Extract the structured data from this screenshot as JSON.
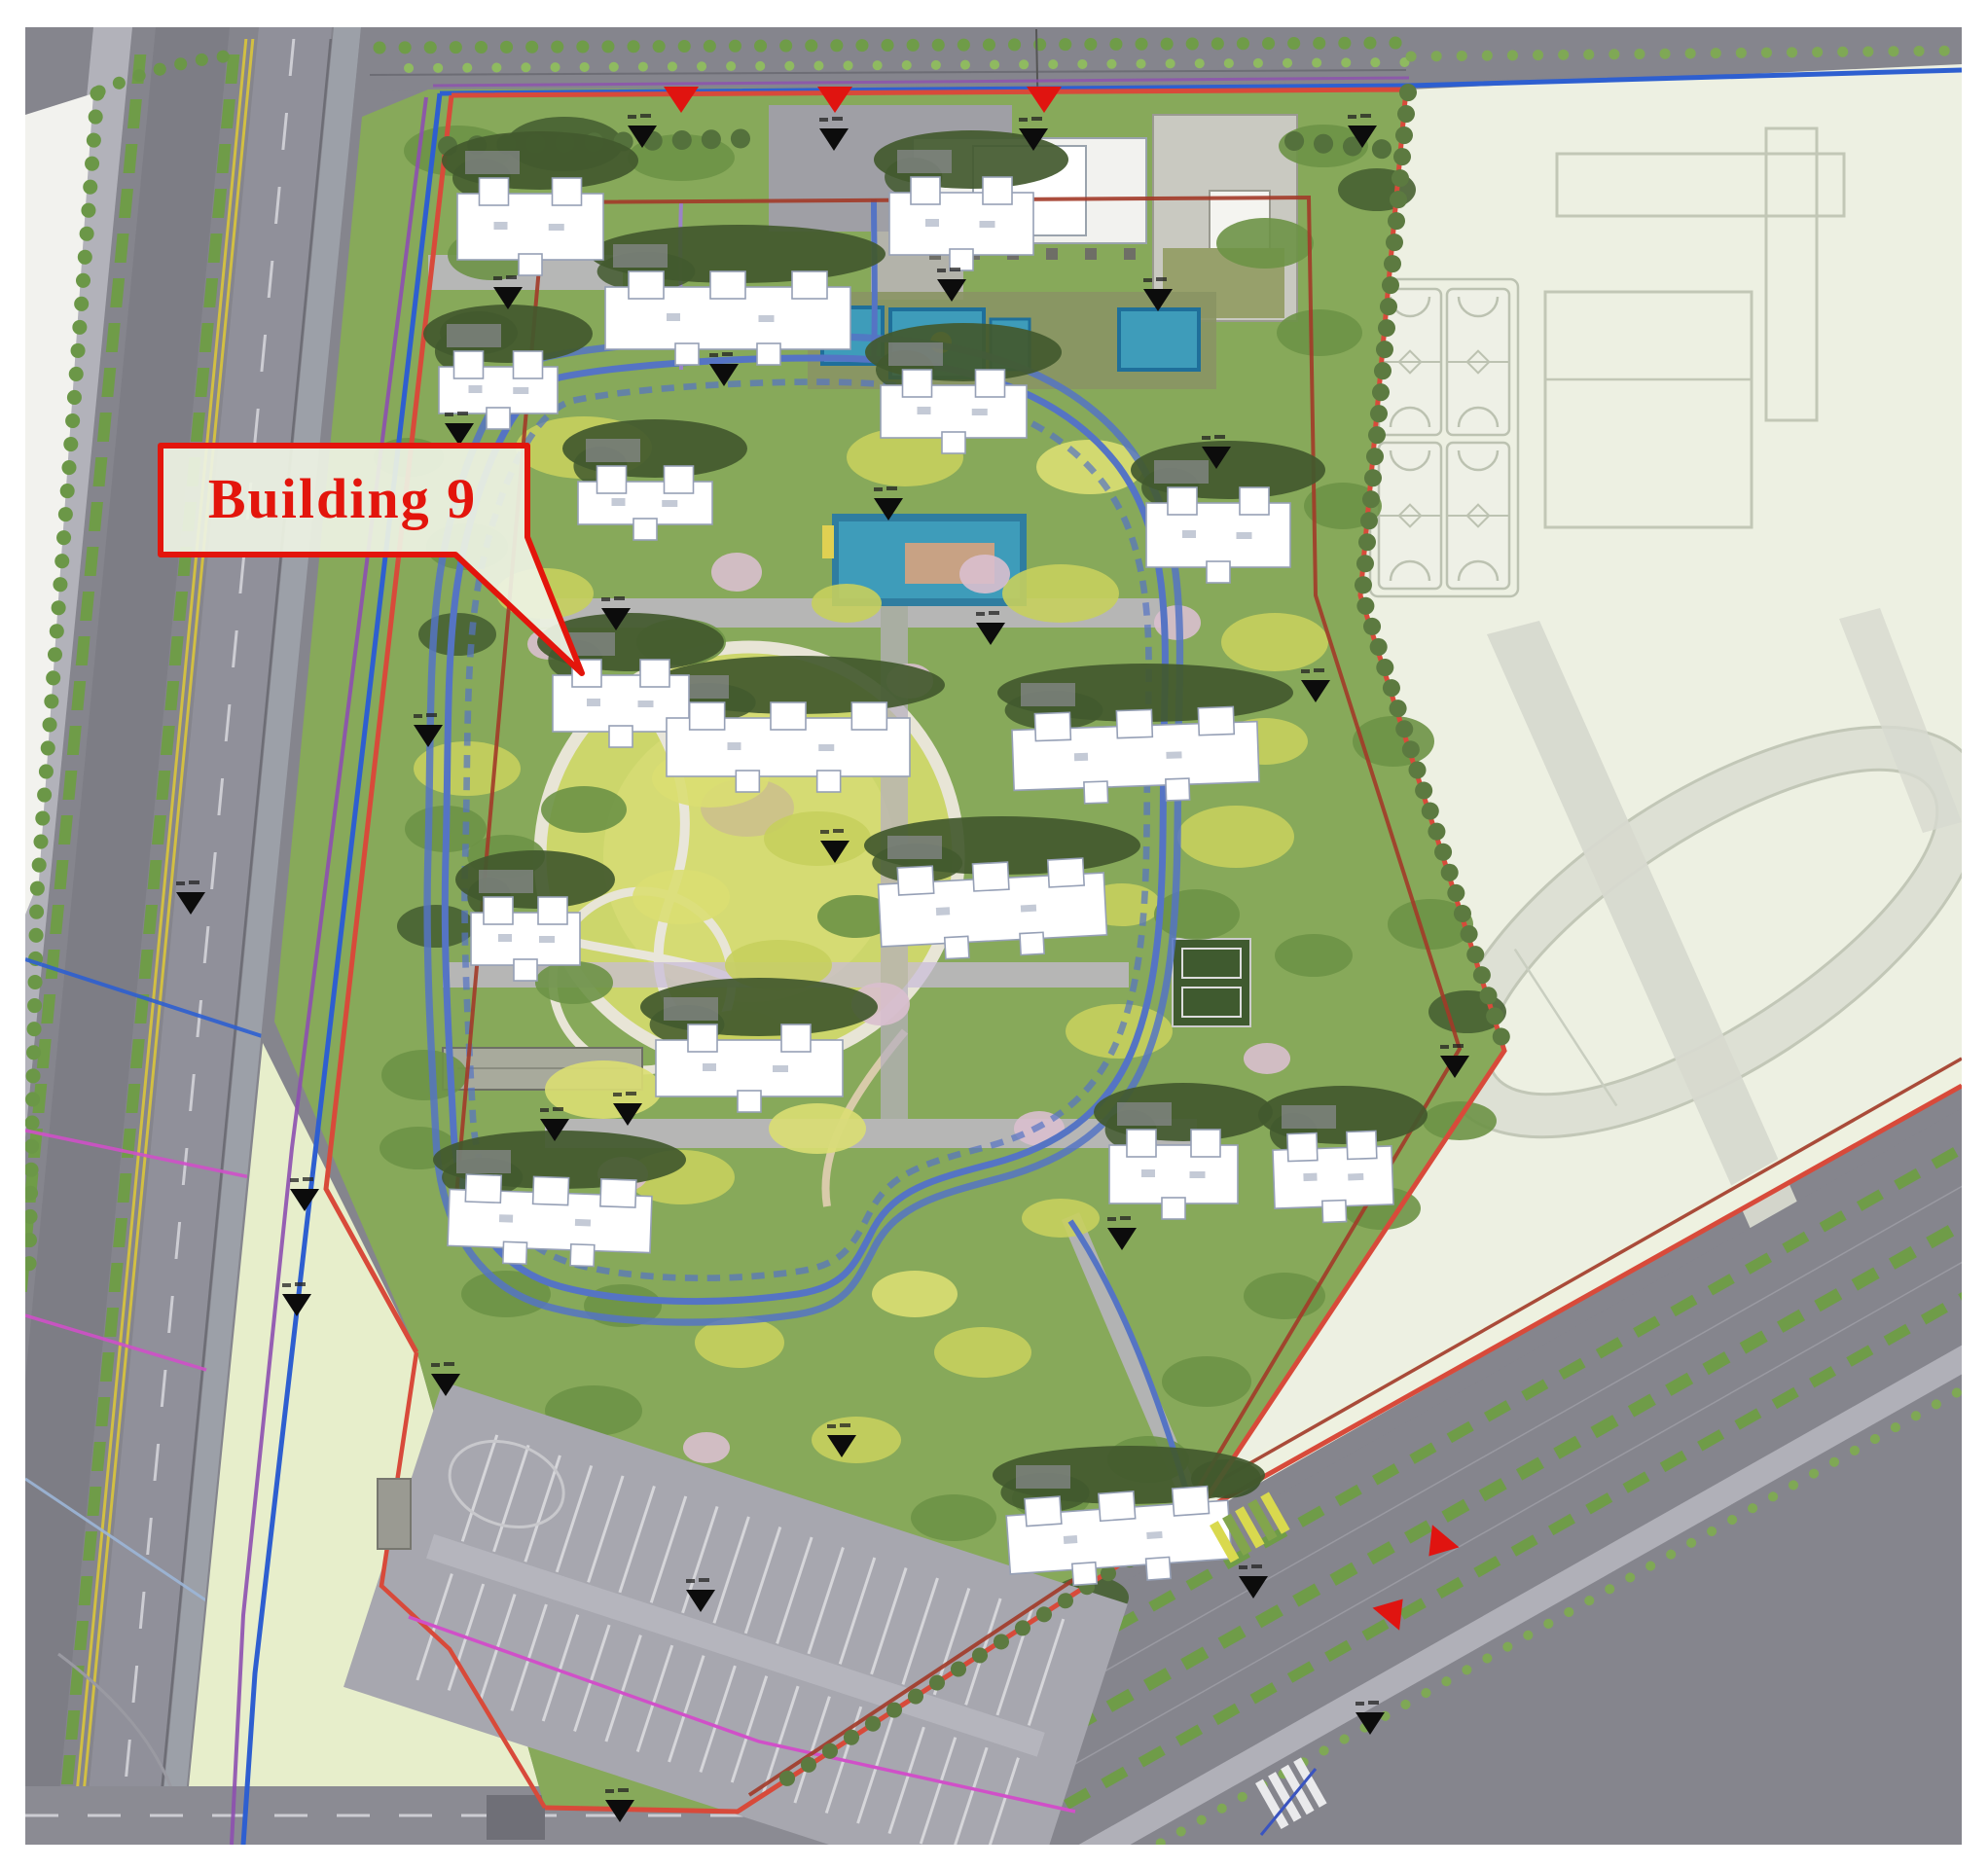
{
  "page": {
    "type": "architectural-site-plan",
    "highlighted_building": "Building 9"
  },
  "callout": {
    "label": "Building 9",
    "text_color": "#e3150c",
    "border_color": "#e3150c",
    "box_fill": "#edf2e3"
  },
  "palette": {
    "boundary_red": "#d84a3a",
    "inner_boundary_red": "#a23a28",
    "utility_blue": "#2e5fd0",
    "loop_road_blue": "#5574c4",
    "boundary_purple": "#8d4fb0",
    "path_purple": "#9b82c8",
    "magenta_line": "#d050c8",
    "site_green": "#87a95a",
    "school_pale": "#edf0e2",
    "water_teal": "#3e9cba",
    "marker_black": "#0c0c0c"
  },
  "annotations": {
    "spot_marker_count": 29,
    "entrance_arrow_count": 5,
    "building_count": 17,
    "basketball_court_count": 4
  }
}
